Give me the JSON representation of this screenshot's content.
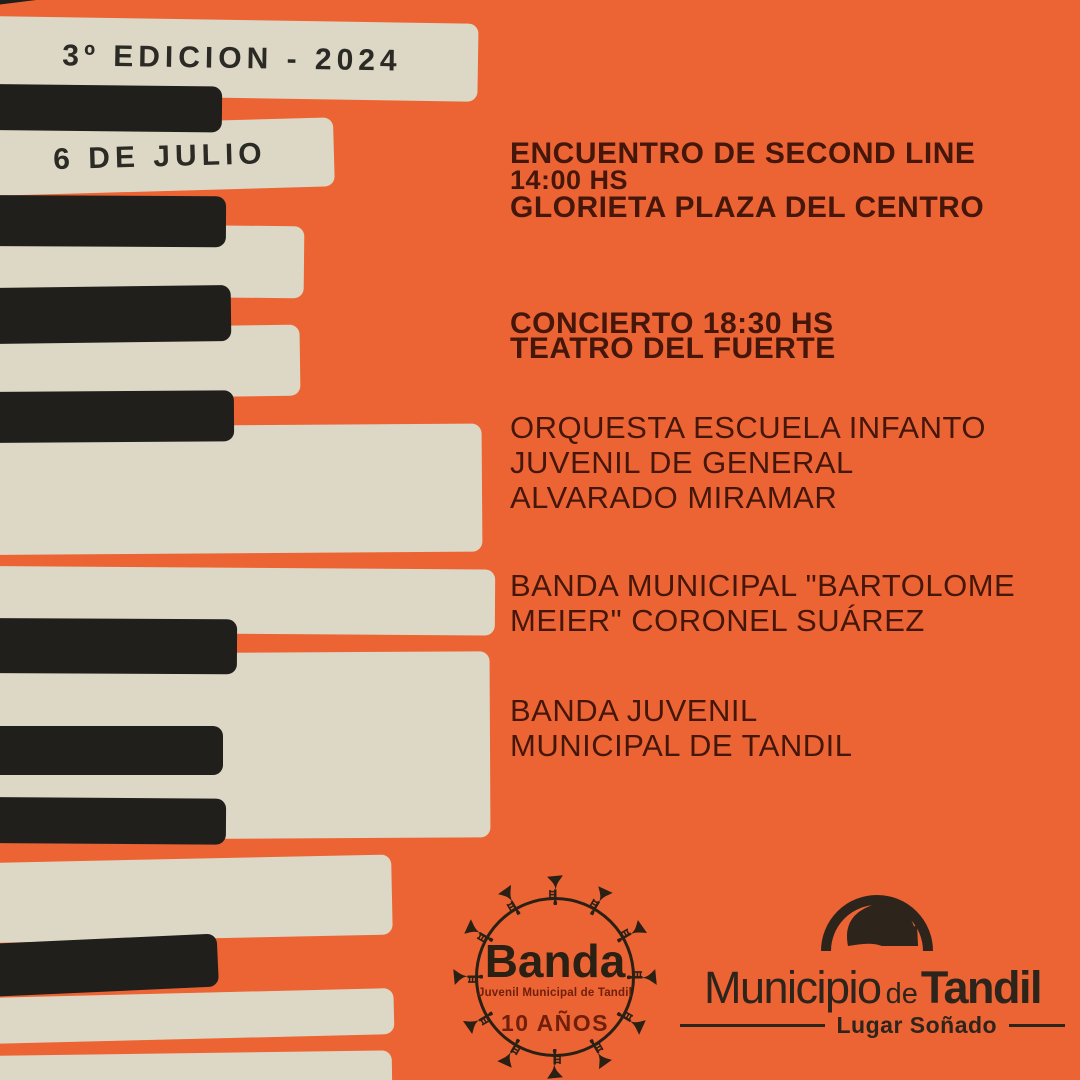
{
  "colors": {
    "background_orange": "#ed6434",
    "key_cream": "#ddd8c6",
    "key_black": "#211f1b",
    "text_brown": "#45170b",
    "logo_ink": "#2d241c",
    "banda_red": "#70200a",
    "banda_ink": "#2b2014",
    "key_title_ink": "#2c2a25"
  },
  "keys_banner": {
    "edition": "3º EDICION - 2024",
    "date": "6 DE JULIO"
  },
  "schedule": {
    "event1_title": "ENCUENTRO DE SECOND LINE",
    "event1_time": "14:00 HS",
    "event1_venue": "GLORIETA PLAZA DEL CENTRO",
    "event2_title": "CONCIERTO 18:30 HS",
    "event2_venue": "TEATRO DEL FUERTE"
  },
  "lineup": {
    "act1": [
      "ORQUESTA ESCUELA INFANTO",
      "JUVENIL DE GENERAL",
      "ALVARADO MIRAMAR"
    ],
    "act2": [
      "BANDA MUNICIPAL \"BARTOLOME",
      "MEIER\" CORONEL SUÁREZ"
    ],
    "act3": [
      "BANDA JUVENIL",
      "MUNICIPAL DE TANDIL"
    ]
  },
  "banda_logo": {
    "name": "Banda",
    "subtitle": "Juvenil Municipal de Tandil",
    "anniversary": "10 AÑOS"
  },
  "municipio_logo": {
    "word_light": "Municipio",
    "word_mid": "de",
    "word_bold": "Tandil",
    "tagline": "Lugar Soñado"
  }
}
